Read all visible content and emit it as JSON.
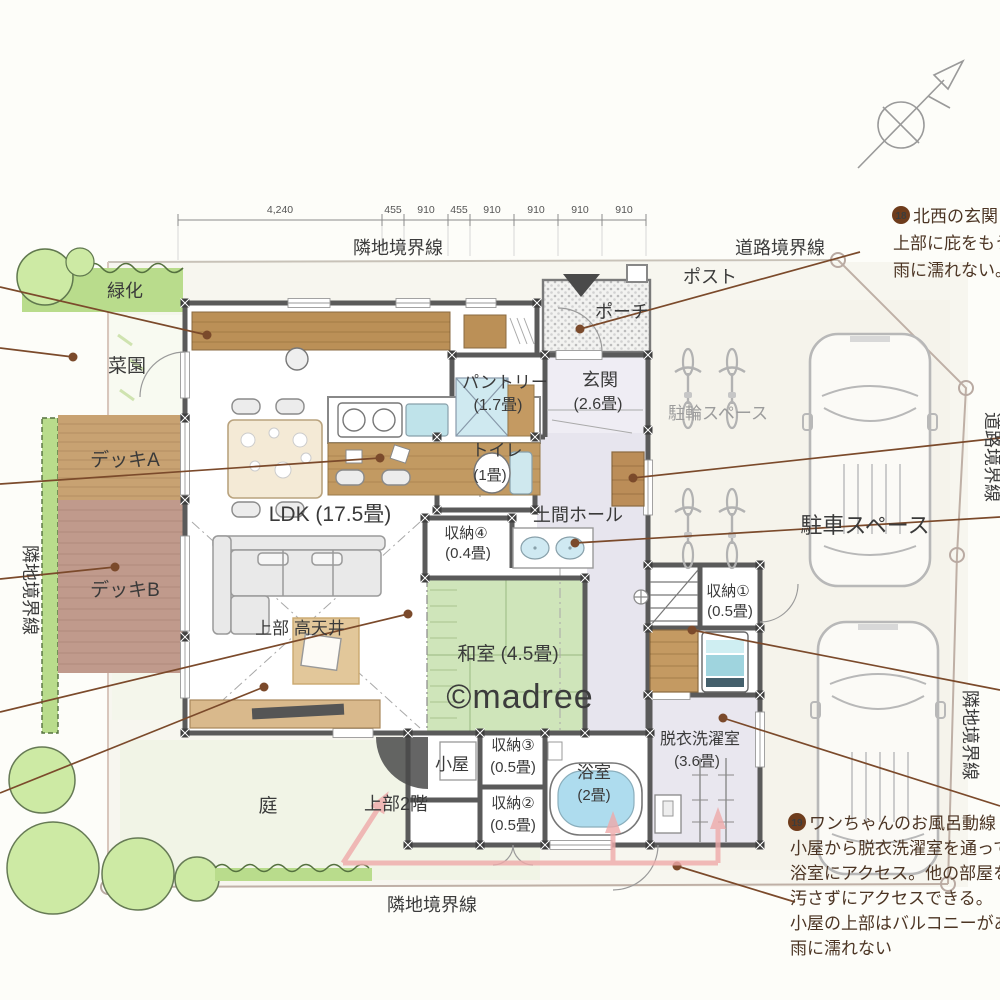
{
  "boundaries": {
    "adjacent": "隣地境界線",
    "road": "道路境界線"
  },
  "dimensions": [
    "4,240",
    "455",
    "910",
    "455",
    "910",
    "910",
    "910",
    "910"
  ],
  "site": {
    "green": "緑化",
    "vegetable_garden": "菜園",
    "deck_a": "デッキA",
    "deck_b": "デッキB",
    "yard": "庭",
    "porch": "ポーチ",
    "post": "ポスト",
    "bicycle_space": "駐輪スペース",
    "parking_space": "駐車スペース"
  },
  "rooms": {
    "ldk": {
      "label": "LDK (17.5畳)"
    },
    "high_ceiling": {
      "label": "上部 高天井"
    },
    "upper_2f": {
      "label": "上部2階"
    },
    "pantry": {
      "name": "パントリー",
      "size": "(1.7畳)"
    },
    "genkan": {
      "name": "玄関",
      "size": "(2.6畳)"
    },
    "toilet": {
      "name": "トイレ",
      "size": "(1畳)"
    },
    "doma_hall": {
      "name": "土間ホール"
    },
    "storage4": {
      "name": "収納④",
      "size": "(0.4畳)"
    },
    "washitsu": {
      "label": "和室 (4.5畳)"
    },
    "storage1": {
      "name": "収納①",
      "size": "(0.5畳)"
    },
    "laundry": {
      "name": "脱衣洗濯室",
      "size": "(3.6畳)"
    },
    "bath": {
      "name": "浴室",
      "size": "(2畳)"
    },
    "storage3": {
      "name": "収納③",
      "size": "(0.5畳)"
    },
    "storage2": {
      "name": "収納②",
      "size": "(0.5畳)"
    },
    "koya": {
      "name": "小屋"
    }
  },
  "annotations": [
    {
      "num": "18",
      "lines": [
        "北西の玄関",
        "上部に庇をもうけ",
        "雨に濡れない。"
      ]
    },
    {
      "num": "19",
      "lines": [
        "ワンちゃんのお風呂動線",
        "小屋から脱衣洗濯室を通って",
        "浴室にアクセス。他の部屋を",
        "汚さずにアクセスできる。",
        "小屋の上部はバルコニーがあり",
        "雨に濡れない"
      ]
    }
  ],
  "watermark": "©madree",
  "colors": {
    "tatami": "#cfe5ba",
    "wood": "#c29a62",
    "deck_a": "#c8a272",
    "deck_b": "#c09a8c",
    "greenery": "#b9dc8c",
    "leader_line": "#7b4a2b",
    "route_arrow": "#efaaaa",
    "water": "#aedcee",
    "annotation_text": "#4c3524",
    "wall": "#5a5a5a"
  }
}
